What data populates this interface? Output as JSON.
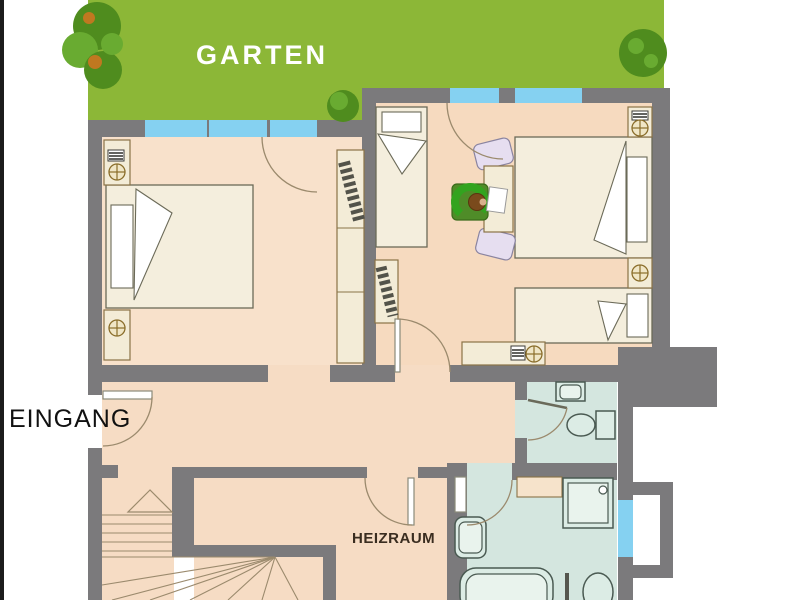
{
  "title": "Apartment floor plan (ground level)",
  "labels": {
    "garden": "GARTEN",
    "entrance": "EINGANG",
    "boiler_room": "HEIZRAUM"
  },
  "icons": {
    "tree": "tree-icon",
    "radiator": "radiator-icon",
    "lamp_cross": "circle-cross-symbol",
    "stair_direction": "stair-direction-arrow"
  },
  "colors": {
    "bg": "#ffffff",
    "edge": "#1c1c1c",
    "garden": "#8cb737",
    "tree_dark": "#4f8c1e",
    "tree_light": "#69ab31",
    "tree_accent": "#c07820",
    "wall": "#7b7a7c",
    "floor": "#f6dcc4",
    "floor_room_left": "#f8e1cb",
    "floor_room_right": "#f6dabf",
    "bath_floor": "#d4e6df",
    "window": "#85d1f1",
    "bed": "#f4eedd",
    "furniture": "#f3ecd7",
    "furniture_outline": "#8a7347",
    "outline": "#6b6a58",
    "fixture_fill": "#dcece5",
    "fixture_outline": "#4a5a52",
    "armchair": "#33a31f",
    "armchair_base": "#4f8c28",
    "head": "#7a4a1c",
    "face": "#d9b08c",
    "chair_lavender": "#e6def0",
    "chair_outline": "#8a84a0",
    "arc": "#9b8a6d",
    "text_garden": "#ffffff",
    "text_entrance": "#111111",
    "text_boiler": "#3a2d20"
  }
}
